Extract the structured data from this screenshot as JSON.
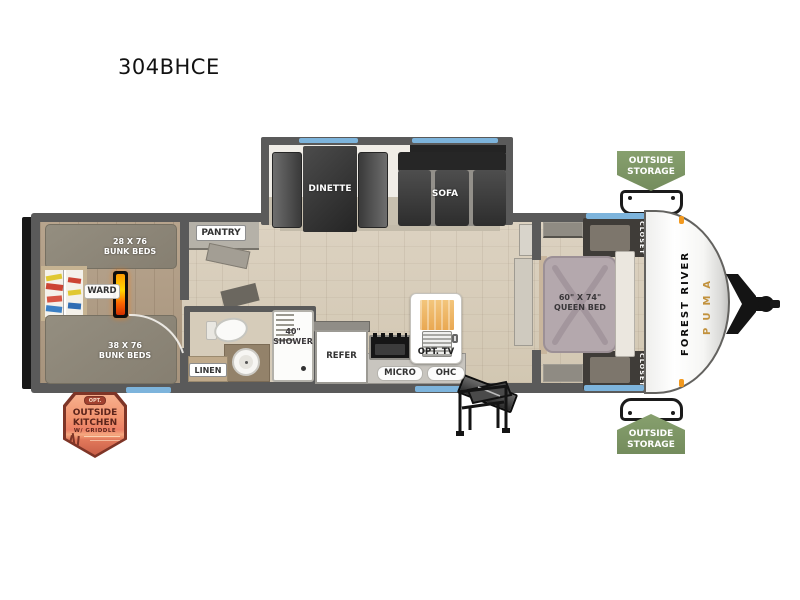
{
  "title": "304BHCE",
  "labels": {
    "dinette": "DINETTE",
    "sofa": "SOFA",
    "pantry": "PANTRY",
    "bunk_top_size": "28 X 76",
    "bunk_top_name": "BUNK BEDS",
    "bunk_bottom_size": "38 X 76",
    "bunk_bottom_name": "BUNK BEDS",
    "ward": "WARD",
    "linen": "LINEN",
    "shower_size": "40\"",
    "shower_name": "SHOWER",
    "refer": "REFER",
    "micro": "MICRO",
    "ohc": "OHC",
    "opt_tv": "OPT. TV",
    "queen_size": "60\" X 74\"",
    "queen_name": "QUEEN BED",
    "closet_top": "CLOSET",
    "closet_bottom": "CLOSET"
  },
  "badges": {
    "storage_top_line1": "OUTSIDE",
    "storage_top_line2": "STORAGE",
    "storage_bottom_line1": "OUTSIDE",
    "storage_bottom_line2": "STORAGE",
    "kitchen_opt": "OPT.",
    "kitchen_line1": "OUTSIDE",
    "kitchen_line2": "KITCHEN",
    "kitchen_line3": "W/ GRIDDLE"
  },
  "brand": {
    "forest_river": "FOREST RIVER",
    "puma": "PUMA"
  },
  "colors": {
    "window_blue": "#7db4dc",
    "badge_green": "#7d9565",
    "puma_gold": "#c2923d",
    "fireplace_orange": "#ff7a00",
    "wall_gray": "#5a5a5a"
  }
}
